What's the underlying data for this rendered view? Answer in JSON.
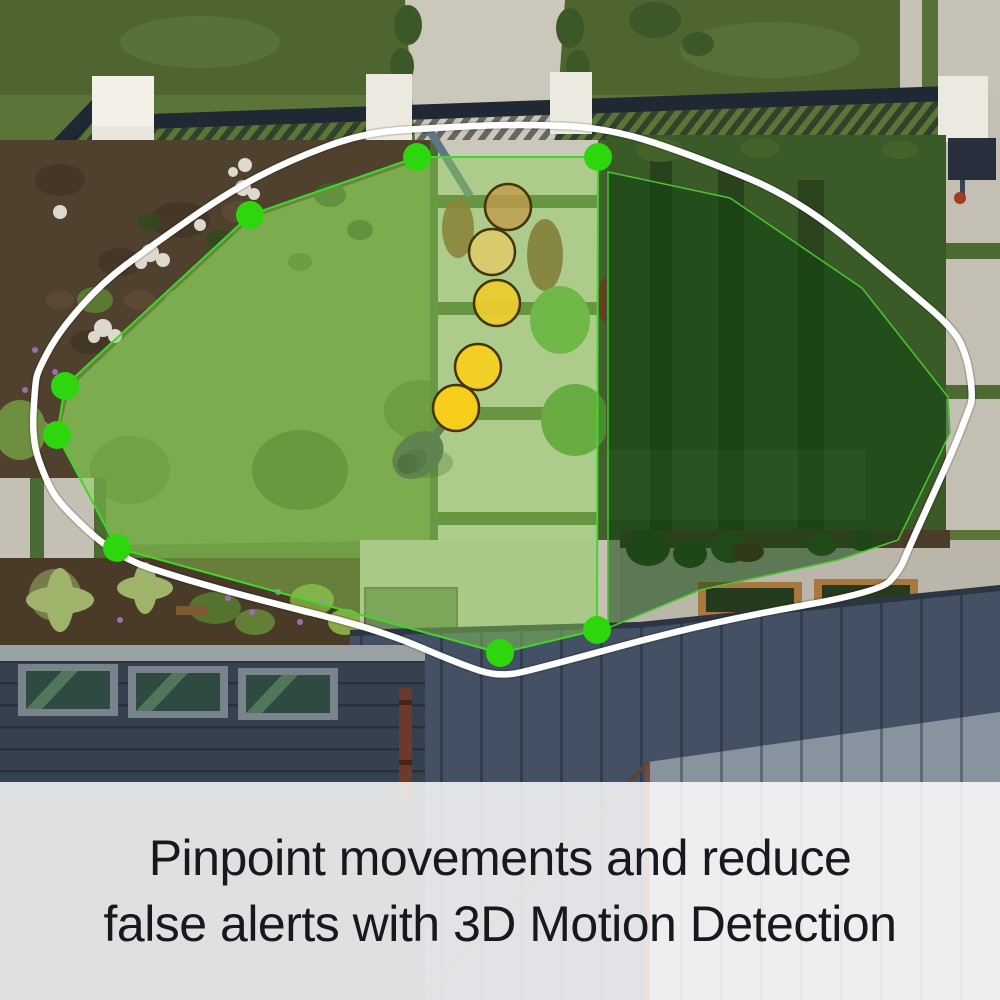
{
  "caption": {
    "line1": "Pinpoint movements and reduce",
    "line2": "false alerts with 3D Motion Detection"
  },
  "overlay": {
    "fov_outline": {
      "color": "#ffffff",
      "width": 6.5,
      "points": [
        [
          500,
          677
        ],
        [
          540,
          668
        ],
        [
          710,
          622
        ],
        [
          880,
          592
        ],
        [
          900,
          570
        ],
        [
          908,
          550
        ],
        [
          952,
          453
        ],
        [
          968,
          412
        ],
        [
          973,
          398
        ],
        [
          968,
          360
        ],
        [
          955,
          330
        ],
        [
          905,
          287
        ],
        [
          800,
          200
        ],
        [
          700,
          158
        ],
        [
          610,
          128
        ],
        [
          520,
          124
        ],
        [
          430,
          128
        ],
        [
          363,
          133
        ],
        [
          290,
          160
        ],
        [
          227,
          193
        ],
        [
          150,
          247
        ],
        [
          103,
          282
        ],
        [
          60,
          330
        ],
        [
          38,
          370
        ],
        [
          35,
          385
        ],
        [
          32,
          440
        ],
        [
          45,
          478
        ],
        [
          60,
          505
        ],
        [
          117,
          557
        ],
        [
          180,
          578
        ],
        [
          260,
          600
        ],
        [
          380,
          630
        ],
        [
          462,
          665
        ]
      ]
    },
    "motion_zone": {
      "fill": "rgba(140,209,86,0.46)",
      "stroke": "#3fd92a",
      "stroke_width": 2,
      "vertices": [
        [
          417,
          157
        ],
        [
          598,
          157
        ],
        [
          597,
          630
        ],
        [
          500,
          653
        ],
        [
          117,
          548
        ],
        [
          57,
          435
        ],
        [
          65,
          386
        ],
        [
          250,
          215
        ]
      ],
      "handle_color": "#2ed60e",
      "handle_radius": 14
    },
    "secondary_zone": {
      "fill": "rgba(16,70,16,0.55)",
      "stroke": "#49c72e",
      "stroke_width": 1.5,
      "vertices": [
        [
          608,
          172
        ],
        [
          730,
          198
        ],
        [
          862,
          288
        ],
        [
          948,
          397
        ],
        [
          950,
          433
        ],
        [
          898,
          540
        ],
        [
          838,
          560
        ],
        [
          700,
          590
        ],
        [
          608,
          628
        ]
      ]
    },
    "motion_trail": {
      "radius": 23,
      "stroke": "#433508",
      "stroke_width": 2.5,
      "points": [
        {
          "x": 508,
          "y": 207,
          "fill": "#c19a4a",
          "opacity": 0.78
        },
        {
          "x": 492,
          "y": 252,
          "fill": "#dfca67",
          "opacity": 0.85
        },
        {
          "x": 497,
          "y": 303,
          "fill": "#eccd2e",
          "opacity": 0.92
        },
        {
          "x": 478,
          "y": 367,
          "fill": "#f4cf1f",
          "opacity": 0.96
        },
        {
          "x": 456,
          "y": 408,
          "fill": "#f5cd1a",
          "opacity": 1
        }
      ]
    },
    "person": {
      "x": 418,
      "y": 455
    }
  }
}
